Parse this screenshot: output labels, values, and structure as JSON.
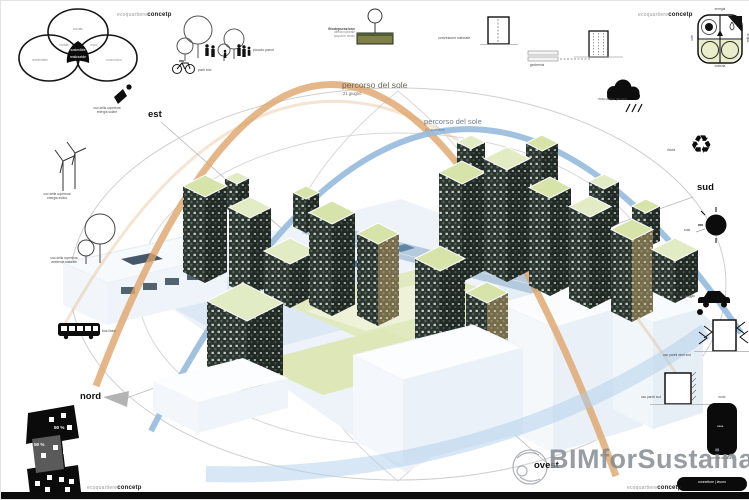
{
  "meta": {
    "brand_light": "ecoquartiere",
    "brand_bold": "concetp"
  },
  "venn": {
    "top": "sociale",
    "overlap_left": "vivibile",
    "overlap_right": "equo",
    "left": "ambientale",
    "right": "economico",
    "center_primary": "sostenibile",
    "center_secondary": "realizzabile"
  },
  "compass": {
    "est": "est",
    "sud": "sud",
    "nord": "nord",
    "ovest": "ovest"
  },
  "sun_path_june": {
    "title": "percorso del sole",
    "date": "21 giugno"
  },
  "sun_path_december": {
    "title": "percorso del sole",
    "date": "21 dicembre"
  },
  "top_icons": {
    "park_caption": "piccolo parco",
    "bike_caption": "park bici",
    "phyto_title": "fitodepurazione",
    "phyto_line1": "difesa naturale",
    "phyto_line2": "acqua in riciclo",
    "convection_caption": "convezione naturale",
    "geothermal_caption": "geotermia"
  },
  "right_icons": {
    "grid_top": "energia",
    "grid_left": "sole",
    "grid_right": "acqua",
    "grid_bottom": "materia",
    "rain_caption": "riuso acqua piovana",
    "recycle_glyph": "♻",
    "recycle_caption": "ricicla",
    "sun_caption": "sole",
    "car_caption": "parcheggio",
    "wall_wind_caption": "uso pareti venti sud",
    "wall_south_caption": "uso pareti sud",
    "heatpump_top": "moto",
    "heatpump_inner": "casa",
    "heatpump_bottom": "pompa di calore",
    "connector_label": "connettore | lavoro"
  },
  "left_icons": {
    "solar_line1": "uso della copertura",
    "solar_line2": "energia solare",
    "wind_line1": "uso della copertura",
    "wind_line2": "energia eolica",
    "nature_line1": "uso della copertura",
    "nature_line2": "ambiente naturale",
    "bus_caption": "bus linea"
  },
  "siteplan": {
    "pct_a": "50 %",
    "pct_b": "50 %"
  },
  "watermark": {
    "text": "BIMforSustainability"
  }
}
